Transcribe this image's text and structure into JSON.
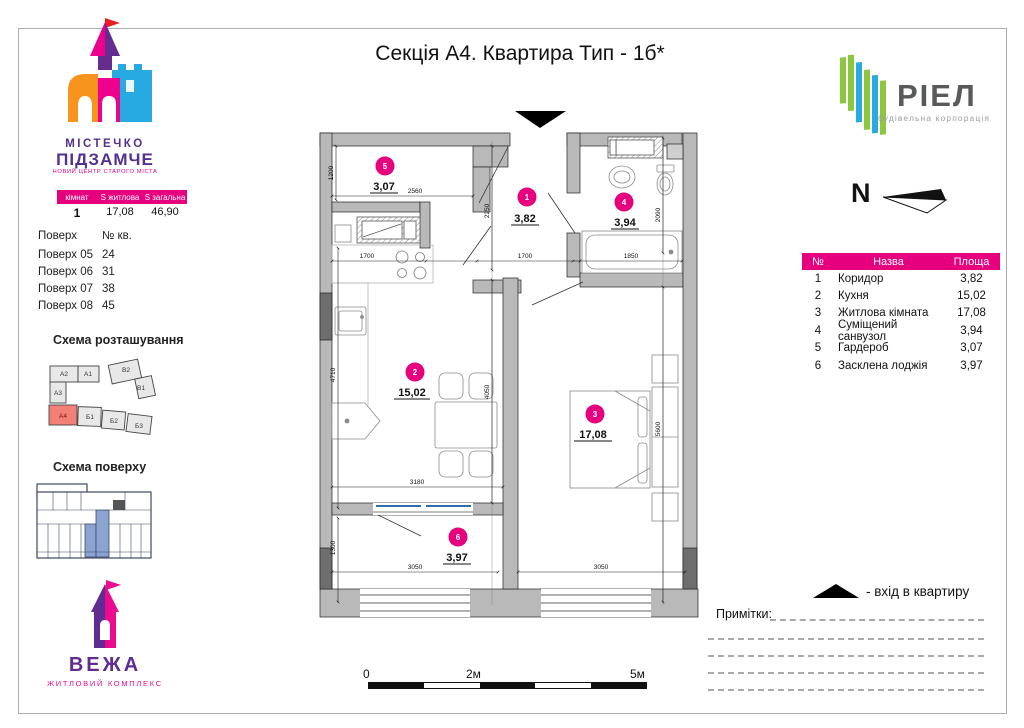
{
  "title": "Секція А4. Квартира Тип - 1б*",
  "logo_mistechko": {
    "line1": "МІСТЕЧКО",
    "line2": "ПІДЗАМЧЕ",
    "tagline": "НОВИЙ ЦЕНТР СТАРОГО МІСТА"
  },
  "logo_riel": {
    "name": "РІЕЛ",
    "tagline": "будівельна корпорація"
  },
  "logo_vezha": {
    "name": "ВЕЖА",
    "tagline": "ЖИТЛОВИЙ КОМПЛЕКС"
  },
  "summary": {
    "h1": "кімнат",
    "h2": "S житлова",
    "h3": "S загальна",
    "rooms": "1",
    "living": "17,08",
    "total": "46,90"
  },
  "floors": {
    "col1": "Поверх",
    "col2": "№ кв.",
    "rows": [
      [
        "Поверх 05",
        "24"
      ],
      [
        "Поверх 06",
        "31"
      ],
      [
        "Поверх 07",
        "38"
      ],
      [
        "Поверх 08",
        "45"
      ]
    ]
  },
  "schemes": {
    "location_title": "Схема розташування",
    "floor_title": "Схема поверху",
    "blocks": {
      "a1": "А1",
      "a2": "А2",
      "a3": "А3",
      "a4": "А4",
      "b1": "Б1",
      "b2": "Б2",
      "b3": "Б3",
      "v1": "В1",
      "v2": "В2"
    }
  },
  "compass": {
    "label": "N"
  },
  "rooms_table": {
    "h_num": "№",
    "h_name": "Назва",
    "h_area": "Площа",
    "rows": [
      [
        "1",
        "Коридор",
        "3,82"
      ],
      [
        "2",
        "Кухня",
        "15,02"
      ],
      [
        "3",
        "Житлова кімната",
        "17,08"
      ],
      [
        "4",
        "Суміщений санвузол",
        "3,94"
      ],
      [
        "5",
        "Гардероб",
        "3,07"
      ],
      [
        "6",
        "Засклена лоджія",
        "3,97"
      ]
    ]
  },
  "legend": {
    "entrance": "-  вхід в квартиру"
  },
  "notes_label": "Примітки:",
  "scale": {
    "t0": "0",
    "t2": "2м",
    "t5": "5м"
  },
  "plan": {
    "rooms": [
      {
        "num": "1",
        "area": "3,82"
      },
      {
        "num": "2",
        "area": "15,02"
      },
      {
        "num": "3",
        "area": "17,08"
      },
      {
        "num": "4",
        "area": "3,94"
      },
      {
        "num": "5",
        "area": "3,07"
      },
      {
        "num": "6",
        "area": "3,97"
      }
    ],
    "dims": {
      "d1200": "1200",
      "d2560": "2560",
      "d2250": "2250",
      "d2090": "2090",
      "d1700a": "1700",
      "d1700b": "1700",
      "d1850": "1850",
      "d4710": "4710",
      "d4050": "4050",
      "d3180": "3180",
      "d5600": "5600",
      "d1300": "1300",
      "d3050a": "3050",
      "d3050b": "3050"
    },
    "colors": {
      "accent": "#e6007e",
      "wall": "#b9b9b9",
      "pillar": "#6e6e6e",
      "window_blue": "#2e6da8",
      "site_highlight": "#f28076",
      "floor_highlight": "#8ba3d0"
    }
  }
}
